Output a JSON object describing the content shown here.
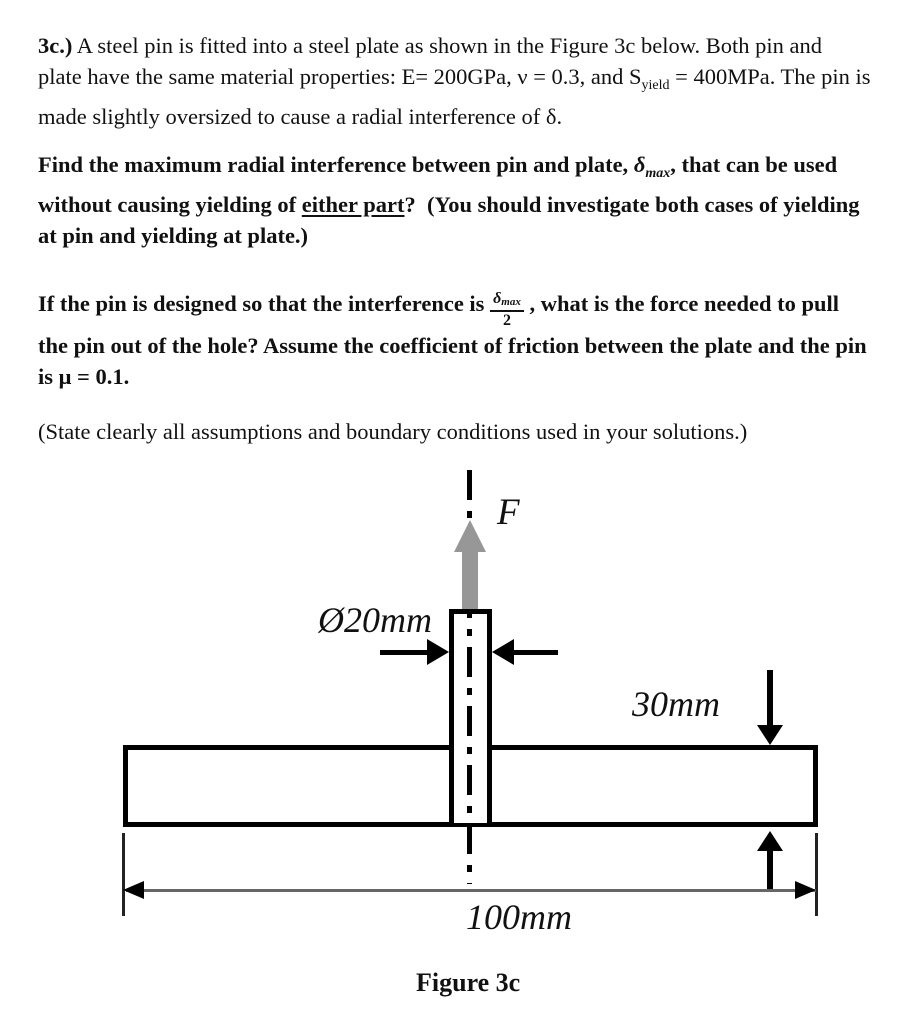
{
  "page": {
    "background": "#ffffff",
    "ink_color": "#111111"
  },
  "problem": {
    "para1": {
      "label": "3c.)",
      "line1": " A steel pin is fitted into a steel plate as shown in the Figure 3c below. Both pin and",
      "line2_pre": "plate have the same material properties: E= 200GPa, ν = 0.3, and S",
      "line2_sub": "yield",
      "line2_post": " = 400MPa. The pin is",
      "line3": "made slightly oversized to cause a radial interference of δ."
    },
    "para2": {
      "line1_pre": "Find the maximum radial interference between pin and plate, ",
      "line1_delta": "δ",
      "line1_delta_sub": "max",
      "line1_post": ", that can be used",
      "line2_pre": "without causing yielding of ",
      "line2_underline": "either part",
      "line2_post": "?  (You should investigate both cases of yielding",
      "line3": "at pin and yielding at plate.)"
    },
    "para3": {
      "line1_pre": "If the pin is designed so that the interference is ",
      "frac_num": "δ",
      "frac_num_sub": "max",
      "frac_den": "2",
      "line1_post": " , what is the force needed to pull",
      "line2": "the pin out of the hole? Assume the coefficient of friction between the plate and the pin",
      "line3": "is μ = 0.1."
    },
    "para4": "(State clearly all assumptions and boundary conditions used in your solutions.)"
  },
  "figure": {
    "force_label": "F",
    "pin_diameter_label": "Ø20mm",
    "plate_thickness_label": "30mm",
    "plate_width_label": "100mm",
    "caption": "Figure 3c",
    "colors": {
      "outline": "#000000",
      "force_arrow_gray": "#979797",
      "dim_line_gray": "#666666"
    }
  }
}
